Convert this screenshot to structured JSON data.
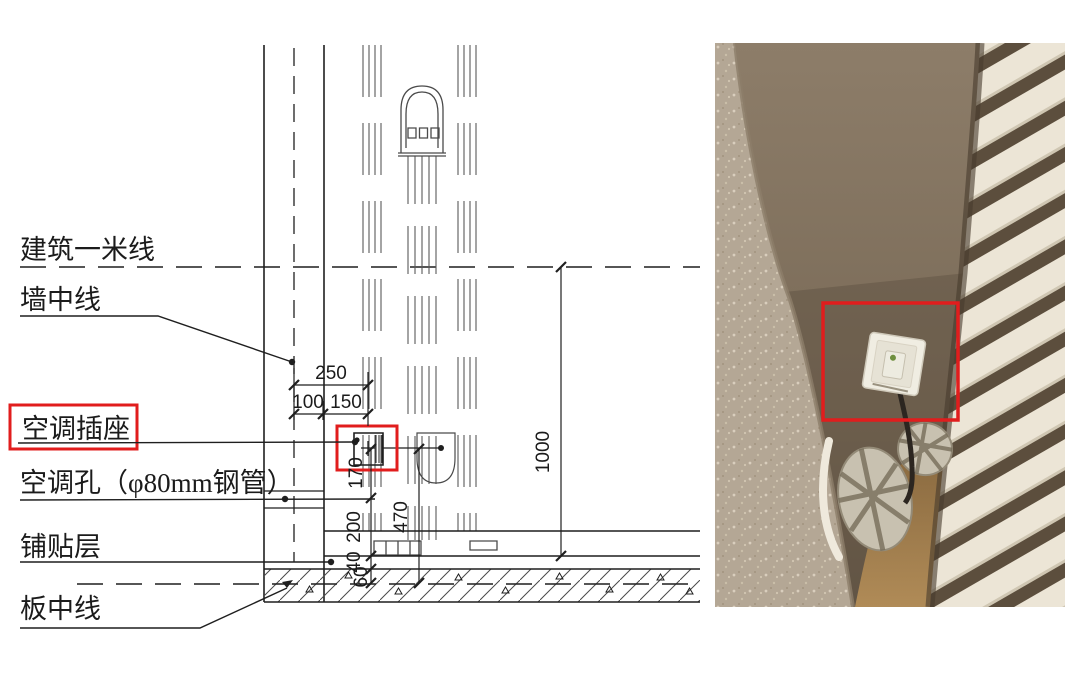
{
  "drawing": {
    "labels": {
      "one_meter_line": "建筑一米线",
      "wall_center_line": "墙中线",
      "ac_socket": "空调插座",
      "ac_hole": "空调孔（φ80mm钢管）",
      "tile_layer": "铺贴层",
      "slab_center_line": "板中线"
    },
    "dimensions": {
      "total_offset": "250",
      "to_wall_face": "100",
      "face_to_socket": "150",
      "meter_line_height": "1000",
      "socket_to_hole": "170",
      "hole_to_floor": "200",
      "tile_thickness": "40",
      "cover_thickness": "60",
      "socket_to_slab_center": "470"
    },
    "highlight_color": "#e11d1d",
    "line_color": "#1f1f1f"
  },
  "photo": {
    "highlight_color": "#e11d1d",
    "wall_color": "#83735f",
    "carpet_color": "#b4a795",
    "slat_color": "#ece5d6",
    "slat_gap_color": "#5c4e3d",
    "wood_floor_color": "#a5814f",
    "socket_color": "#f0ede2"
  }
}
